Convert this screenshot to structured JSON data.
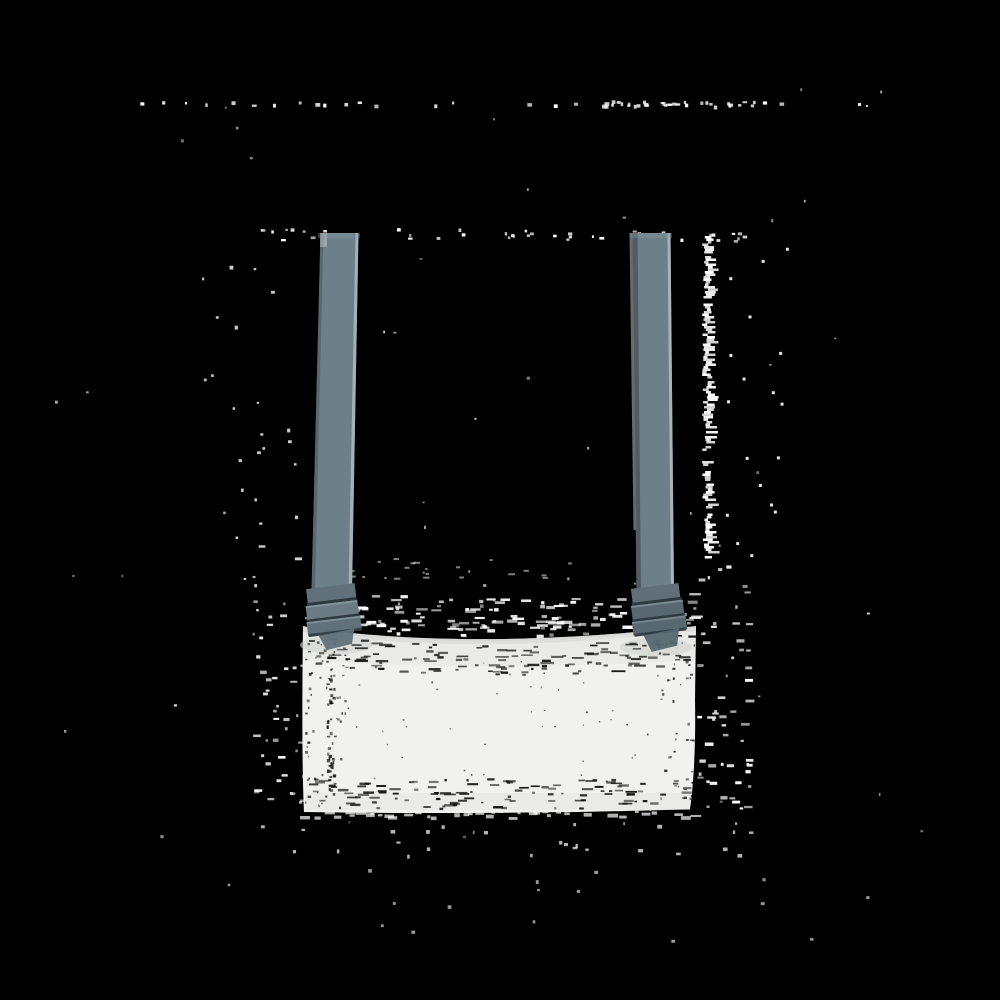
{
  "scene": {
    "subject": "crossbody-bag-product-photo",
    "description_elements": [
      "shoulder-strap-left",
      "shoulder-strap-right",
      "pleated-strap-ends",
      "bag-body"
    ],
    "background_style": "transparent-alpha-rendered-black-with-dither-noise"
  },
  "colors": {
    "background": "#000000",
    "strap": "#6d8089",
    "strap_hl": "#b6c0c5",
    "strap_sh": "#47535a",
    "strap_edge_light": "#cdd5d8",
    "pleat": "#60717b",
    "pleat2": "#6b7b84",
    "pleat_r": "#576871",
    "pleat_r2": "#626f79",
    "pleat_dark": "#2e383f",
    "pleat_light": "#8a9aa2",
    "bag": "#f1f1ef",
    "bag_seam": "#c2c5c1",
    "bag_tint": "#e3e4e0",
    "smudge": "#cfd2cd",
    "noise_white": "#ffffff",
    "noise_black": "#0a0a0a"
  },
  "geometry": {
    "strap_top_y": 233,
    "strap_bottom_y": 590,
    "pleat_bottom_y": 648,
    "bag_left_x": 302,
    "bag_right_x": 697,
    "bag_top_edge_y": 626,
    "bag_top_sag": 13,
    "bag_bottom_y": 813
  },
  "noise": {
    "topline": {
      "y": 101,
      "x_start": 135,
      "x_end": 815,
      "extra_cluster": 25
    },
    "strapline": {
      "y": 228,
      "x_start": 255,
      "x_end": 755,
      "count": 42
    },
    "right_band": {
      "x": 702,
      "y_start": 236,
      "y_end": 558
    },
    "right_sparse": 18,
    "left_sparse": 20,
    "bagtop_dashes": 150,
    "above_sparse": 25,
    "halo_left": 45,
    "halo_right": 55,
    "below_sparse": 26,
    "far_bottom": 14,
    "general": 62,
    "interior_top": 120,
    "interior_bottom": 115,
    "interior_left": 62,
    "interior_left_column": 42,
    "interior_right": 42,
    "interior_center": 42
  }
}
